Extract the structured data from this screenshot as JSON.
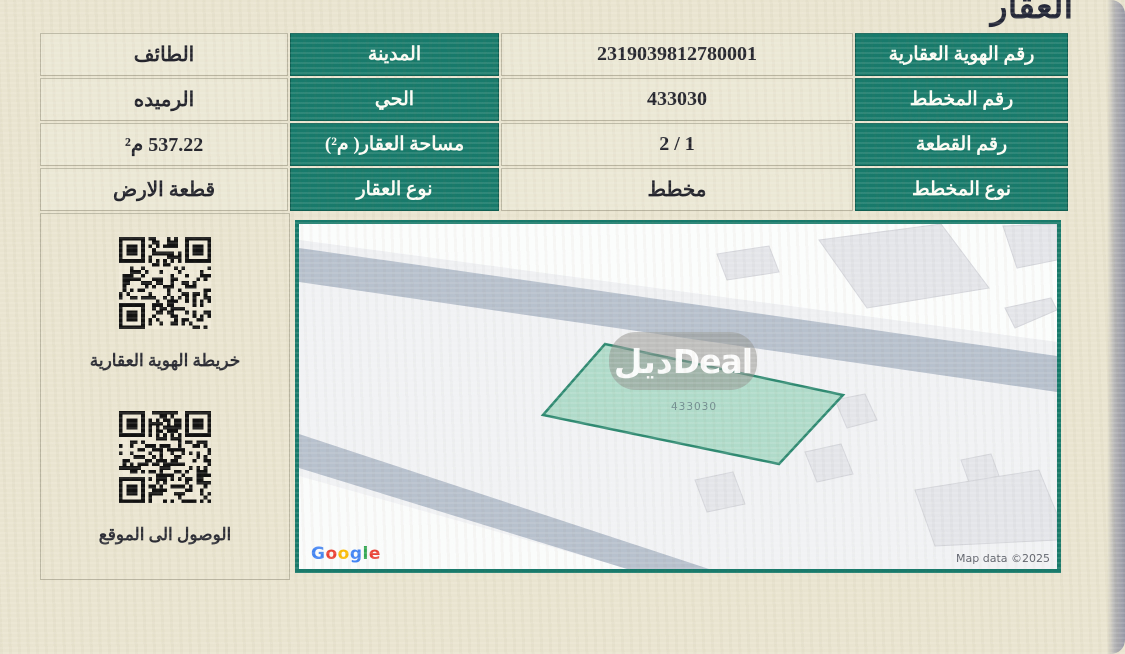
{
  "title": "العقار",
  "table": {
    "rows": [
      {
        "field": "رقم الهوية العقارية",
        "value": "2319039812780001",
        "field2": "المدينة",
        "value2": "الطائف"
      },
      {
        "field": "رقم المخطط",
        "value": "433030",
        "field2": "الحي",
        "value2": "الرميده"
      },
      {
        "field": "رقم القطعة",
        "value": "2 / 1",
        "field2": "مساحة العقار( م²)",
        "value2": "537.22 م²"
      },
      {
        "field": "نوع المخطط",
        "value": "مخطط",
        "field2": "نوع العقار",
        "value2": "قطعة الارض"
      }
    ]
  },
  "qr": {
    "map_qr_label": "خريطة الهوية العقارية",
    "location_qr_label": "الوصول الى الموقع"
  },
  "map": {
    "plot_label": "433030",
    "watermark": "ديلDeal",
    "logo": "Google",
    "attribution": "Map data ©2025",
    "colors": {
      "accent_green": "#177a6a",
      "plot_fill": "#a5d7c2",
      "plot_stroke": "#2f8a72",
      "road_gray": "#b7c0cd"
    }
  }
}
